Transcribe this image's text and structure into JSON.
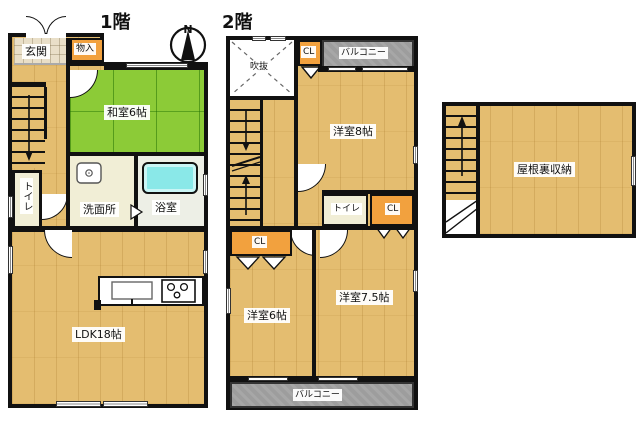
{
  "titles": {
    "floor1": "1階",
    "floor2": "2階"
  },
  "compass": {
    "north_label": "N"
  },
  "floor1": {
    "genkan": "玄関",
    "monoire": "物入",
    "washitsu": "和室6帖",
    "senmenjo": "洗面所",
    "yokushitsu": "浴室",
    "toilet": "トイレ",
    "ldk": "LDK18帖"
  },
  "floor2": {
    "fukinuke": "吹抜",
    "cl_top": "CL",
    "balcony_top": "バルコニー",
    "room8": "洋室8帖",
    "toilet": "トイレ",
    "cl_right": "CL",
    "cl_left": "CL",
    "room6": "洋室6帖",
    "room75": "洋室7.5帖",
    "balcony_bottom": "バルコニー"
  },
  "attic": {
    "storage": "屋根裏収納"
  },
  "colors": {
    "wall": "#111111",
    "wood_floor": "#e4bd70",
    "tatami_green": "#8ccb37",
    "closet_orange": "#f2a13e",
    "cream_floor": "#f1eed6",
    "balcony_gray": "#9d9d9d",
    "bathtub_cyan": "#8ae8e8"
  }
}
